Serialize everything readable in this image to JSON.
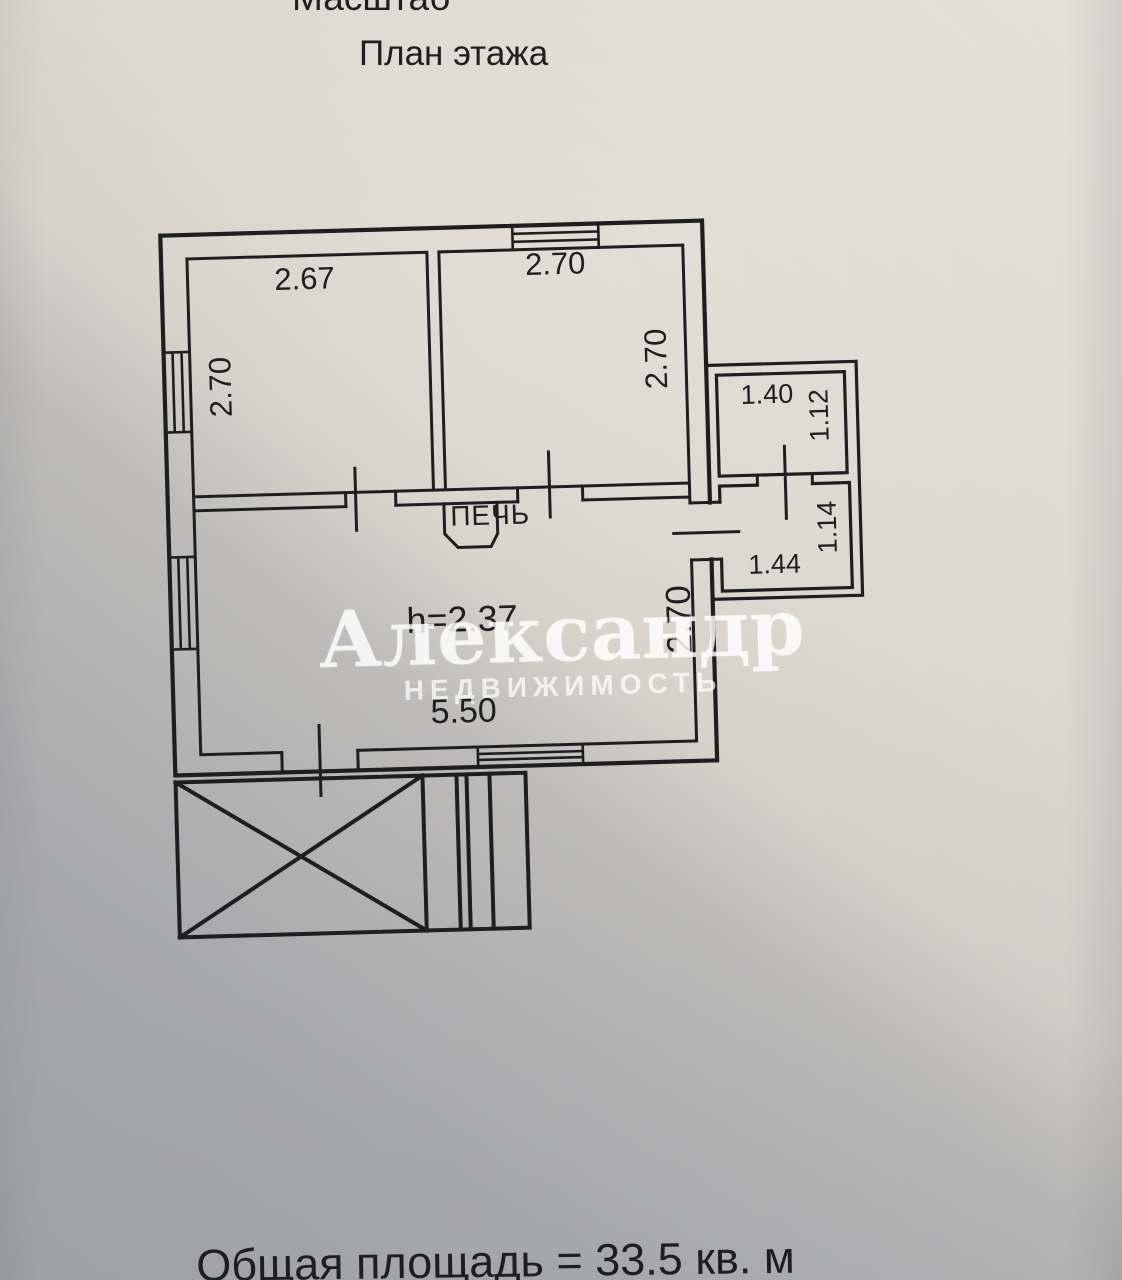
{
  "header": {
    "scale_label": "Масштаб",
    "title": "План этажа"
  },
  "plan": {
    "rooms": {
      "top_left": {
        "width": "2.67",
        "depth": "2.70"
      },
      "top_right": {
        "width": "2.70",
        "depth": "2.70"
      },
      "main": {
        "stove": "ПЕЧЬ",
        "ceiling_height": "h=2.37",
        "width": "5.50",
        "depth": "2.70"
      },
      "annex_top": {
        "width": "1.40",
        "depth": "1.12"
      },
      "annex_bottom": {
        "width": "1.44",
        "depth": "1.14"
      }
    }
  },
  "watermark": {
    "line1": "Александр",
    "line2": "НЕДВИЖИМОСТЬ"
  },
  "footer": {
    "total_area": "Общая площадь = 33.5 кв. м"
  },
  "colors": {
    "ink": "#1e1e20",
    "paper_light": "#d8d4cb",
    "paper_shadow": "#aeb3bd",
    "watermark": "#ffffff"
  }
}
